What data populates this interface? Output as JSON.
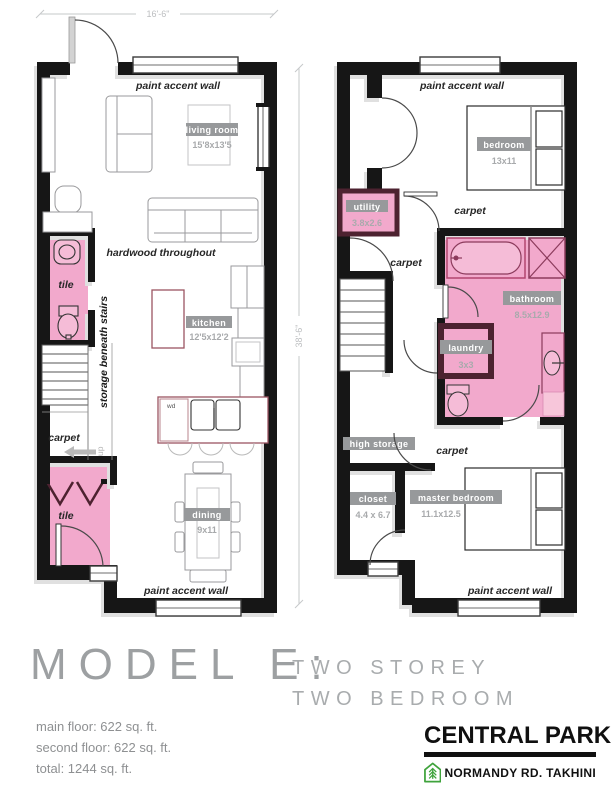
{
  "colors": {
    "pink": "#f2a9cc",
    "pink_light": "#f5bcd7",
    "wall": "#161616",
    "maroon": "#4d2230",
    "counter_red": "#9c5562",
    "badge_bg": "#97999b",
    "badge_text": "#ffffff",
    "dim_gray": "#bcbec0",
    "muted": "#a8aaac",
    "title_gray": "#9da0a2",
    "logo_green": "#3fa33c"
  },
  "floor1": {
    "width_dim": "16'-6\"",
    "height_dim": "38'-6\"",
    "paint_accent_top": "paint accent wall",
    "paint_accent_bottom": "paint accent wall",
    "hardwood_note": "hardwood throughout",
    "powder_tile": "tile",
    "entry_tile": "tile",
    "carpet": "carpet",
    "up_label": "up",
    "storage_note": "storage beneath stairs",
    "wd_label": "wd",
    "living": {
      "name": "living room",
      "dims": "15'8x13'5"
    },
    "kitchen": {
      "name": "kitchen",
      "dims": "12'5x12'2"
    },
    "dining": {
      "name": "dining",
      "dims": "9x11"
    }
  },
  "floor2": {
    "paint_accent_top": "paint accent wall",
    "paint_accent_bottom": "paint accent wall",
    "carpet_hall_upper": "carpet",
    "carpet_hall_mid": "carpet",
    "carpet_hall_lower": "carpet",
    "high_storage": "high storage",
    "bedroom": {
      "name": "bedroom",
      "dims": "13x11"
    },
    "utility": {
      "name": "utility",
      "dims": "3.8x2.6"
    },
    "bathroom": {
      "name": "bathroom",
      "dims": "8.5x12.9"
    },
    "laundry": {
      "name": "laundry",
      "dims": "3x3"
    },
    "closet": {
      "name": "closet",
      "dims": "4.4 x 6.7"
    },
    "master": {
      "name": "master bedroom",
      "dims": "11.1x12.5"
    }
  },
  "title": {
    "model": "MODEL E:",
    "line1": "TWO STOREY",
    "line2": "TWO BEDROOM"
  },
  "stats": {
    "main": "main floor: 622 sq. ft.",
    "second": "second floor: 622 sq. ft.",
    "total": "total: 1244 sq. ft."
  },
  "logo": {
    "brand": "CENTRAL PARK",
    "subtitle": "NORMANDY RD. TAKHINI"
  }
}
